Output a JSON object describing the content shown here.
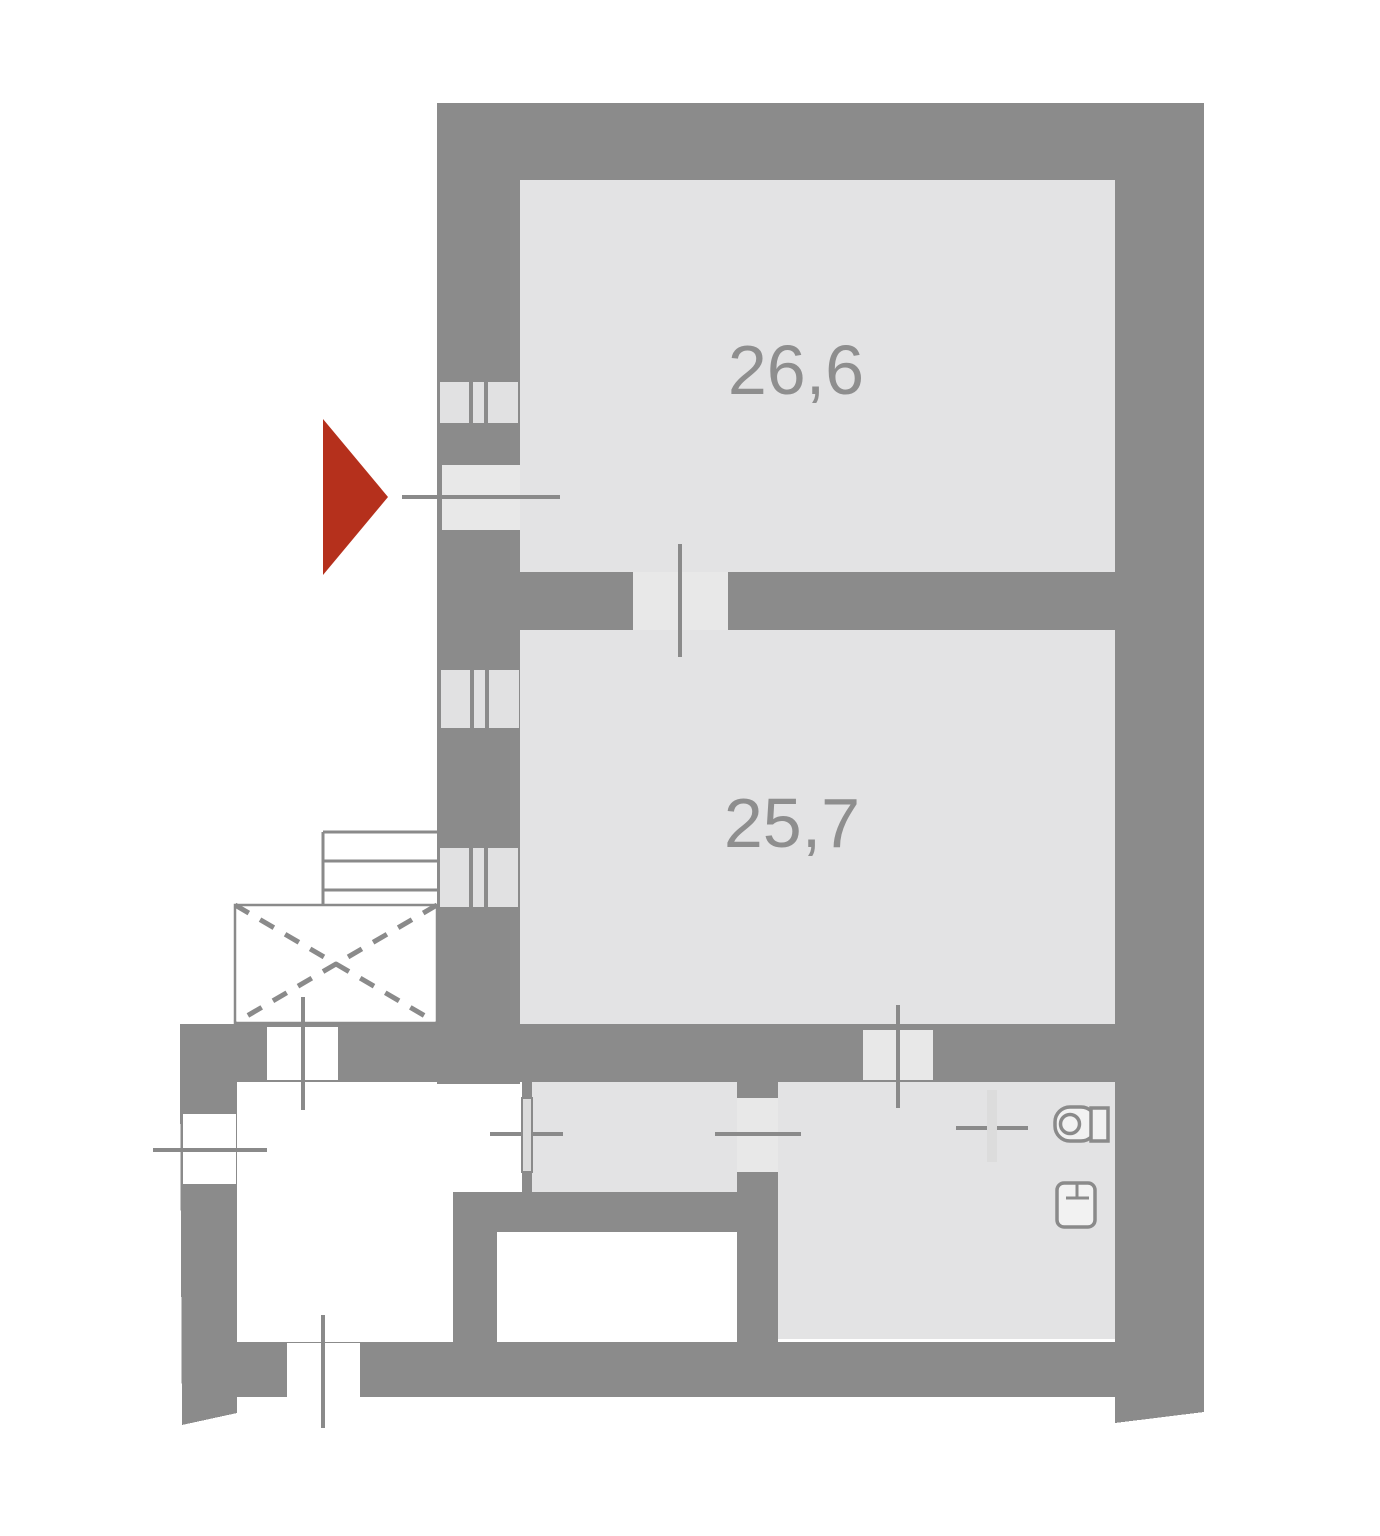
{
  "plan": {
    "type": "apartment-floor-plan",
    "rooms": [
      {
        "id": "room-top",
        "area_label": "26,6"
      },
      {
        "id": "room-middle",
        "area_label": "25,7"
      }
    ],
    "colors": {
      "wall": "#8B8B8B",
      "room_fill": "#E3E3E4",
      "opening_fill": "#E8E8E8",
      "line": "#8A8A8A",
      "window_pane": "#E1E1E2",
      "door_leaf": "#DCDCDC",
      "fixture_fill": "#F2F2F2",
      "arrow_red": "#B5301C",
      "label_text": "#8E8E8E",
      "background": "#FFFFFF"
    },
    "icons": {
      "entrance_arrow": "entrance-arrow-icon",
      "toilet": "toilet-icon",
      "washbasin": "washbasin-icon",
      "stairs": "stairs-icon",
      "shaft_cross": "shaft-cross-icon",
      "window": "window-icon",
      "door_axis": "door-axis-line"
    }
  }
}
